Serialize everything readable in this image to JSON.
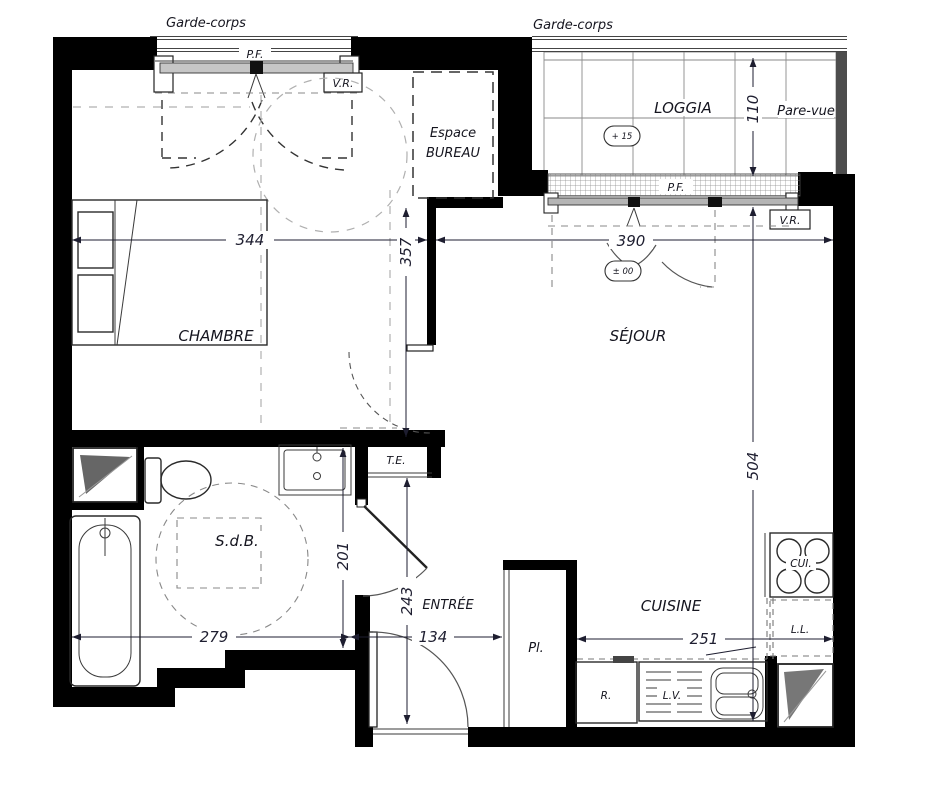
{
  "labels": {
    "garde_corps_left": "Garde-corps",
    "garde_corps_right": "Garde-corps",
    "pf_chambre": "P.F.",
    "vr_chambre": "V.R.",
    "pf_sejour": "P.F.",
    "vr_sejour": "V.R.",
    "espace_bureau_line1": "Espace",
    "espace_bureau_line2": "BUREAU",
    "loggia": "LOGGIA",
    "pare_vue": "Pare-vue",
    "level_loggia": "+ 15",
    "level_sejour": "± 00",
    "chambre": "CHAMBRE",
    "sejour": "SÉJOUR",
    "sdb": "S.d.B.",
    "te": "T.E.",
    "entree": "ENTRÉE",
    "placard": "Pl.",
    "cuisine": "CUISINE",
    "cuisson": "CUI.",
    "lave_linge": "L.L.",
    "refrigerateur": "R.",
    "lave_vaisselle": "L.V."
  },
  "dims": {
    "chambre_width": "344",
    "chambre_depth": "357",
    "sejour_width": "390",
    "sejour_depth": "504",
    "loggia_depth": "110",
    "sdb_width": "279",
    "sdb_depth": "201",
    "entree_width": "134",
    "entree_depth": "243",
    "cuisine_width": "251"
  }
}
